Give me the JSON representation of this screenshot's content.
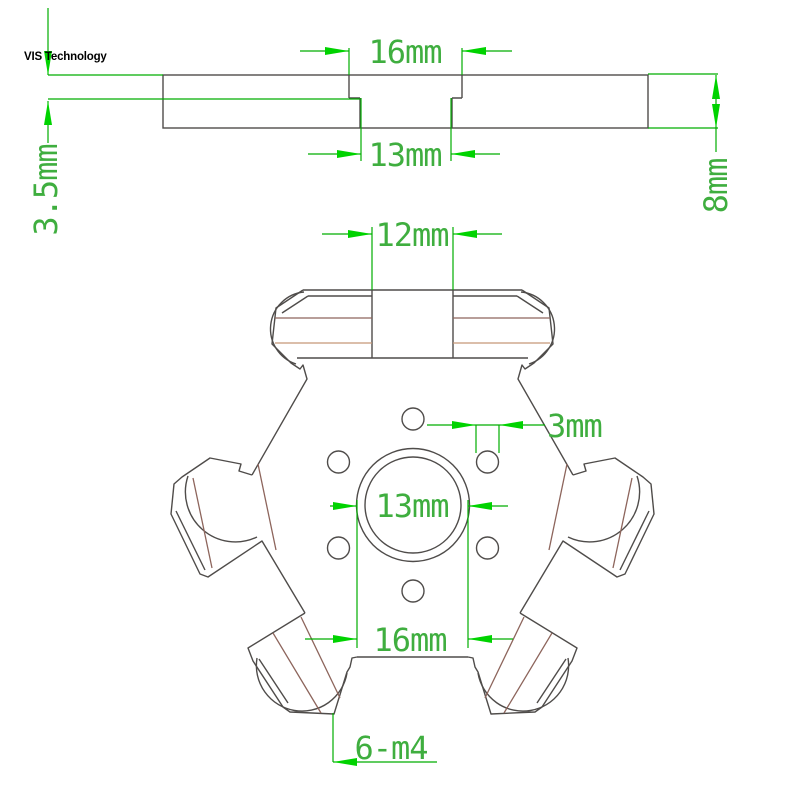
{
  "watermark": "VIS Technology",
  "colors": {
    "dimension_line_green": "#00ad00",
    "arrow_green": "#00d300",
    "dimension_text_green": "#3fae3f",
    "part_outline_gray": "#4f4c4a",
    "detail_brown": "#8d655c",
    "detail_tan": "#c59877",
    "background": "#ffffff",
    "watermark_color": "#000000"
  },
  "side_view": {
    "dim_top_groove_width": "16mm",
    "dim_bottom_slot_width": "13mm",
    "dim_recess_depth": "3.5mm",
    "dim_plate_thickness": "8mm"
  },
  "plan_view": {
    "dim_tab_width": "12mm",
    "dim_small_hole_diameter": "3mm",
    "dim_center_bore_diameter": "13mm",
    "dim_bottom_edge_width": "16mm",
    "dim_holes_callout": "6-m4"
  }
}
